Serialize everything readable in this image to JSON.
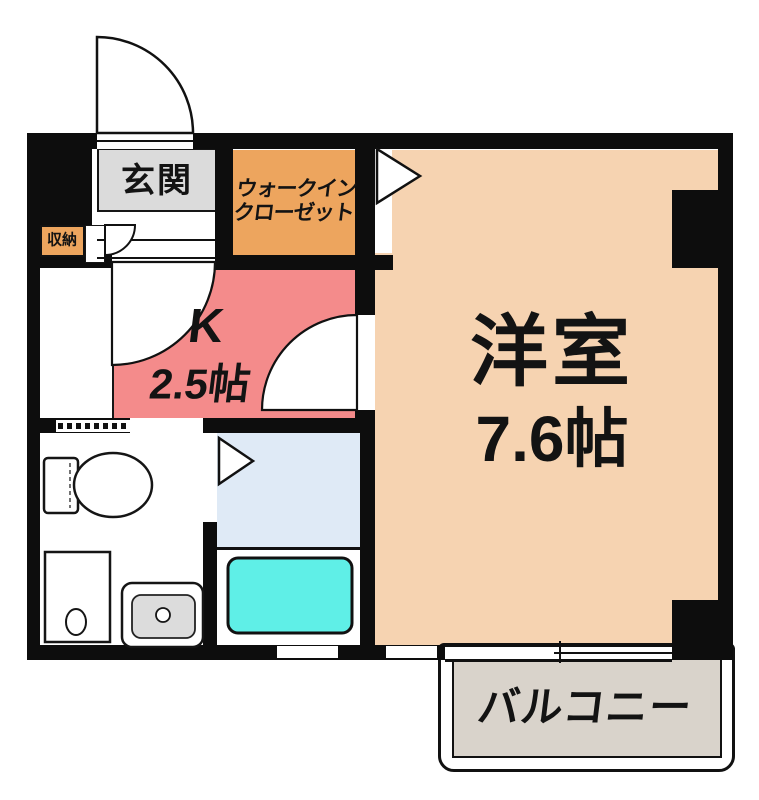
{
  "rooms": {
    "genkan": {
      "label": "玄関"
    },
    "walk_in_closet": {
      "label_line1": "ウォークイン",
      "label_line2": "クローゼット"
    },
    "storage": {
      "label": "収納"
    },
    "kitchen": {
      "label": "K",
      "area": "2.5帖"
    },
    "western_room": {
      "label": "洋室",
      "area": "7.6帖"
    },
    "balcony": {
      "label": "バルコニー"
    }
  },
  "colors": {
    "wall": "#0d0d0d",
    "genkan_gray": "#dbdbdb",
    "closet_orange": "#eda55e",
    "kitchen_pink": "#f48b8b",
    "room_peach": "#f6d3b1",
    "bathroom_blue": "#dfeaf6",
    "bathtub_cyan": "#5fefe7",
    "balcony_gray": "#d9d3cb"
  }
}
